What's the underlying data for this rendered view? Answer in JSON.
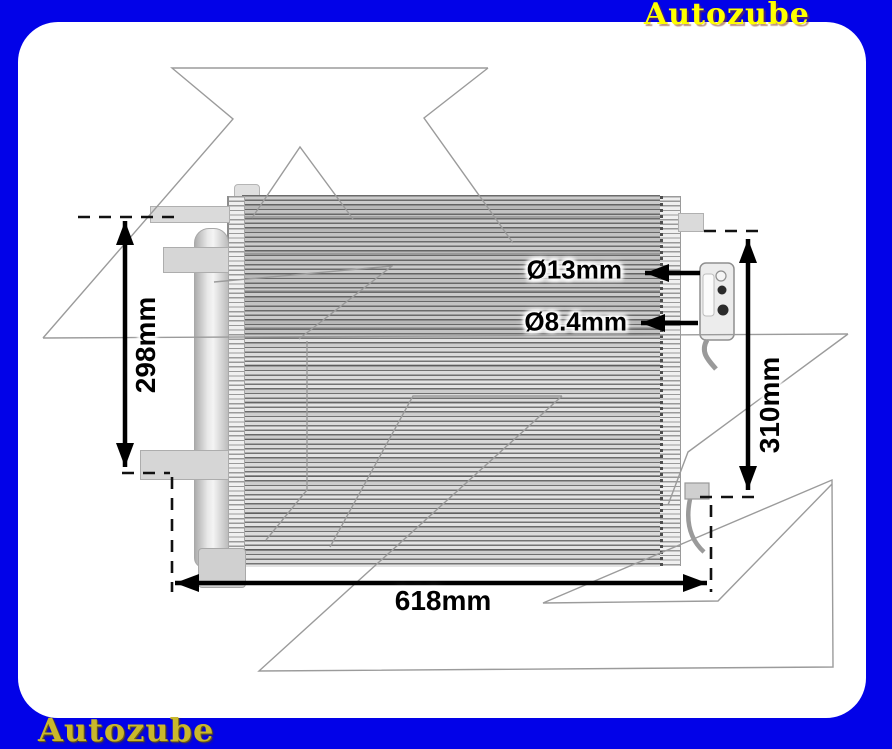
{
  "brand": {
    "top_label": "Autozube",
    "bottom_label": "Autozube"
  },
  "annotations": {
    "left_height": "298mm",
    "right_height": "310mm",
    "bottom_width": "618mm",
    "port_top_diameter": "Ø13mm",
    "port_bottom_diameter": "Ø8.4mm"
  },
  "colors": {
    "frame": "#0202e8",
    "brand_top": "#ffff00",
    "brand_bottom": "#c9b82b",
    "dimension": "#000000",
    "watermark": "#9b9b9b"
  }
}
